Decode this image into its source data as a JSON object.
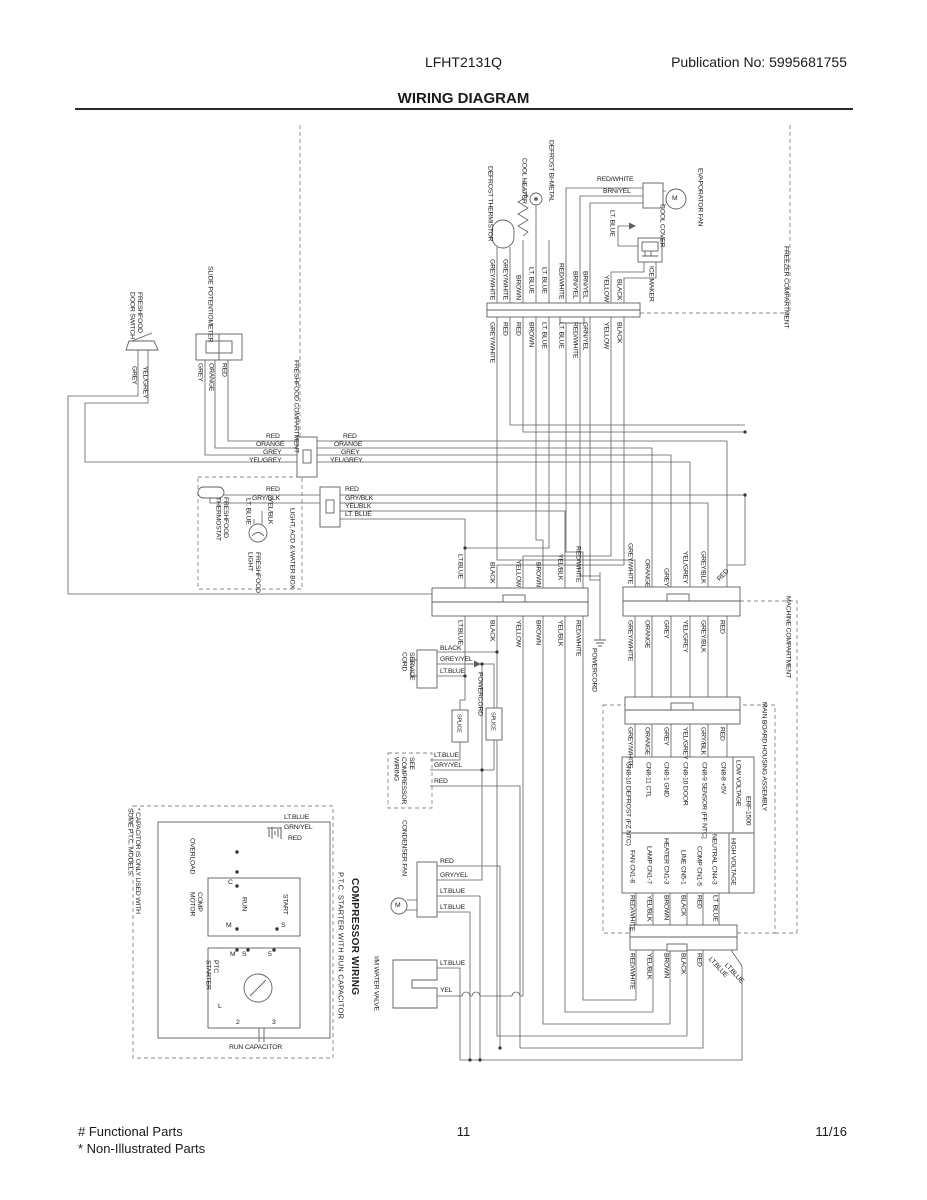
{
  "header": {
    "model": "LFHT2131Q",
    "publication": "Publication No:  5995681755",
    "title": "WIRING DIAGRAM"
  },
  "footer": {
    "functional": "# Functional Parts",
    "non_illustrated": "* Non-Illustrated Parts",
    "page": "11",
    "date": "11/16"
  },
  "diagram": {
    "labels": [
      {
        "t": "FRESHFOOD\nDOOR SWITCH",
        "x": 128,
        "y": 292,
        "o": "v"
      },
      {
        "t": "GREY",
        "x": 130,
        "y": 366,
        "o": "v"
      },
      {
        "t": "YEL/GREY",
        "x": 141,
        "y": 366,
        "o": "v"
      },
      {
        "t": "SLIDE POTENTIOMETER",
        "x": 206,
        "y": 266,
        "o": "v"
      },
      {
        "t": "GREY",
        "x": 196,
        "y": 363,
        "o": "v"
      },
      {
        "t": "ORANGE",
        "x": 207,
        "y": 363,
        "o": "v"
      },
      {
        "t": "RED",
        "x": 220,
        "y": 363,
        "o": "v"
      },
      {
        "t": "FRESHFOOD COMPARTMENT",
        "x": 292,
        "y": 360,
        "o": "v"
      },
      {
        "t": "RED",
        "x": 266,
        "y": 433
      },
      {
        "t": "ORANGE",
        "x": 256,
        "y": 441
      },
      {
        "t": "GREY",
        "x": 263,
        "y": 449
      },
      {
        "t": "YEL/GREY",
        "x": 249,
        "y": 457
      },
      {
        "t": "RED",
        "x": 343,
        "y": 433
      },
      {
        "t": "ORANGE",
        "x": 334,
        "y": 441
      },
      {
        "t": "GREY",
        "x": 341,
        "y": 449
      },
      {
        "t": "YEL/GREY",
        "x": 330,
        "y": 457
      },
      {
        "t": "RED",
        "x": 266,
        "y": 486
      },
      {
        "t": "GRY/BLK",
        "x": 252,
        "y": 495
      },
      {
        "t": "RED",
        "x": 345,
        "y": 486
      },
      {
        "t": "GRY/BLK",
        "x": 345,
        "y": 495
      },
      {
        "t": "YEL/BLK",
        "x": 345,
        "y": 503
      },
      {
        "t": "LT. BLUE",
        "x": 345,
        "y": 511
      },
      {
        "t": "FRESHFOOD\nTHERMOSTAT",
        "x": 214,
        "y": 497,
        "o": "v"
      },
      {
        "t": "LIGHT, ACD & WATER BOX",
        "x": 288,
        "y": 508,
        "o": "v"
      },
      {
        "t": "LT. BLUE",
        "x": 244,
        "y": 498,
        "o": "v"
      },
      {
        "t": "YEL/BLK",
        "x": 266,
        "y": 498,
        "o": "v"
      },
      {
        "t": "FRESHFOOD\nLIGHT",
        "x": 246,
        "y": 552,
        "o": "v"
      },
      {
        "t": "DEFROST THERMISTOR",
        "x": 486,
        "y": 166,
        "o": "v"
      },
      {
        "t": "COOL HEATER",
        "x": 520,
        "y": 158,
        "o": "v"
      },
      {
        "t": "DEFROST BI-METAL",
        "x": 547,
        "y": 140,
        "o": "v"
      },
      {
        "t": "RED/WHITE",
        "x": 597,
        "y": 176
      },
      {
        "t": "BRN/YEL",
        "x": 603,
        "y": 188
      },
      {
        "t": "LT. BLUE",
        "x": 608,
        "y": 210,
        "o": "v"
      },
      {
        "t": "COOL COVER",
        "x": 658,
        "y": 204,
        "o": "v"
      },
      {
        "t": "EVAPORATOR FAN",
        "x": 696,
        "y": 168,
        "o": "v"
      },
      {
        "t": "M",
        "x": 672,
        "y": 195
      },
      {
        "t": "ICE MAKER",
        "x": 647,
        "y": 266,
        "o": "v"
      },
      {
        "t": "FREEZER COMPARTMENT",
        "x": 782,
        "y": 246,
        "o": "v"
      },
      {
        "t": "GREY/WHITE",
        "x": 488,
        "y": 259,
        "o": "v"
      },
      {
        "t": "GREY/WHITE",
        "x": 501,
        "y": 259,
        "o": "v"
      },
      {
        "t": "BROWN",
        "x": 514,
        "y": 275,
        "o": "v"
      },
      {
        "t": "LT. BLUE",
        "x": 527,
        "y": 267,
        "o": "v"
      },
      {
        "t": "LT. BLUE",
        "x": 540,
        "y": 267,
        "o": "v"
      },
      {
        "t": "RED/WHITE",
        "x": 557,
        "y": 263,
        "o": "v"
      },
      {
        "t": "BRN/YEL",
        "x": 571,
        "y": 271,
        "o": "v"
      },
      {
        "t": "BRN/YEL",
        "x": 581,
        "y": 271,
        "o": "v"
      },
      {
        "t": "YELLOW",
        "x": 602,
        "y": 275,
        "o": "v"
      },
      {
        "t": "BLACK",
        "x": 615,
        "y": 279,
        "o": "v"
      },
      {
        "t": "GREY/WHITE",
        "x": 488,
        "y": 322,
        "o": "v"
      },
      {
        "t": "RED",
        "x": 501,
        "y": 322,
        "o": "v"
      },
      {
        "t": "RED",
        "x": 514,
        "y": 322,
        "o": "v"
      },
      {
        "t": "BROWN",
        "x": 527,
        "y": 322,
        "o": "v"
      },
      {
        "t": "LT. BLUE",
        "x": 540,
        "y": 322,
        "o": "v"
      },
      {
        "t": "LT. BLUE",
        "x": 557,
        "y": 322,
        "o": "v"
      },
      {
        "t": "RED/WHITE",
        "x": 571,
        "y": 322,
        "o": "v"
      },
      {
        "t": "GRN/YEL",
        "x": 581,
        "y": 322,
        "o": "v"
      },
      {
        "t": "YELLOW",
        "x": 602,
        "y": 322,
        "o": "v"
      },
      {
        "t": "BLACK",
        "x": 615,
        "y": 322,
        "o": "v"
      },
      {
        "t": "LT.BLUE",
        "x": 456,
        "y": 554,
        "o": "v"
      },
      {
        "t": "BLACK",
        "x": 488,
        "y": 562,
        "o": "v"
      },
      {
        "t": "YELLOW",
        "x": 514,
        "y": 560,
        "o": "v"
      },
      {
        "t": "BROWN",
        "x": 534,
        "y": 562,
        "o": "v"
      },
      {
        "t": "YEL/BLK",
        "x": 556,
        "y": 554,
        "o": "v"
      },
      {
        "t": "RED/WHITE",
        "x": 574,
        "y": 546,
        "o": "v"
      },
      {
        "t": "LT.BLUE",
        "x": 456,
        "y": 620,
        "o": "v"
      },
      {
        "t": "BLACK",
        "x": 488,
        "y": 620,
        "o": "v"
      },
      {
        "t": "YELLOW",
        "x": 514,
        "y": 620,
        "o": "v"
      },
      {
        "t": "BROWN",
        "x": 534,
        "y": 620,
        "o": "v"
      },
      {
        "t": "YEL/BLK",
        "x": 556,
        "y": 620,
        "o": "v"
      },
      {
        "t": "RED/WHITE",
        "x": 574,
        "y": 620,
        "o": "v"
      },
      {
        "t": "GREY/WHITE",
        "x": 626,
        "y": 543,
        "o": "v"
      },
      {
        "t": "ORANGE",
        "x": 643,
        "y": 559,
        "o": "v"
      },
      {
        "t": "GREY",
        "x": 662,
        "y": 568,
        "o": "v"
      },
      {
        "t": "YEL/GREY",
        "x": 681,
        "y": 551,
        "o": "v"
      },
      {
        "t": "GREY/BLK",
        "x": 699,
        "y": 551,
        "o": "v"
      },
      {
        "t": "RED",
        "x": 716,
        "y": 578,
        "o": "e"
      },
      {
        "t": "GREY/WHITE",
        "x": 626,
        "y": 620,
        "o": "v"
      },
      {
        "t": "ORANGE",
        "x": 643,
        "y": 620,
        "o": "v"
      },
      {
        "t": "GREY",
        "x": 662,
        "y": 620,
        "o": "v"
      },
      {
        "t": "YEL/GREY",
        "x": 681,
        "y": 620,
        "o": "v"
      },
      {
        "t": "GREY/BLK",
        "x": 699,
        "y": 620,
        "o": "v"
      },
      {
        "t": "RED",
        "x": 718,
        "y": 620,
        "o": "v"
      },
      {
        "t": "POWERCORD",
        "x": 590,
        "y": 648,
        "o": "v"
      },
      {
        "t": "SERVICE\nCORD",
        "x": 400,
        "y": 652,
        "o": "v"
      },
      {
        "t": "BLACK",
        "x": 440,
        "y": 645
      },
      {
        "t": "GREY/YEL",
        "x": 440,
        "y": 656
      },
      {
        "t": "LT.BLUE",
        "x": 440,
        "y": 668
      },
      {
        "t": "POWERCORD",
        "x": 476,
        "y": 672,
        "o": "v"
      },
      {
        "t": "SPLICE",
        "x": 455,
        "y": 714,
        "o": "v",
        "s": "st"
      },
      {
        "t": "SPLICE",
        "x": 489,
        "y": 712,
        "o": "v",
        "s": "st"
      },
      {
        "t": "SEE\nCOMPRESSOR\nWIRING",
        "x": 392,
        "y": 757,
        "o": "v"
      },
      {
        "t": "LT.BLUE",
        "x": 434,
        "y": 752
      },
      {
        "t": "GRY/YEL",
        "x": 434,
        "y": 762
      },
      {
        "t": "RED",
        "x": 434,
        "y": 778
      },
      {
        "t": "CONDENSER FAN",
        "x": 400,
        "y": 820,
        "o": "v"
      },
      {
        "t": "M",
        "x": 395,
        "y": 902
      },
      {
        "t": "RED",
        "x": 440,
        "y": 858
      },
      {
        "t": "GRY/YEL",
        "x": 440,
        "y": 872
      },
      {
        "t": "LT.BLUE",
        "x": 440,
        "y": 888
      },
      {
        "t": "LT.BLUE",
        "x": 440,
        "y": 904
      },
      {
        "t": "I/M WATER VALVE",
        "x": 372,
        "y": 956,
        "o": "v"
      },
      {
        "t": "LT.BLUE",
        "x": 440,
        "y": 960
      },
      {
        "t": "YEL",
        "x": 440,
        "y": 987
      },
      {
        "t": "MACHINE COMPARTMENT",
        "x": 784,
        "y": 596,
        "o": "v"
      },
      {
        "t": "MAIN BOARD HOUSING ASSEMBLY",
        "x": 760,
        "y": 702,
        "o": "v"
      },
      {
        "t": "ERF-1500",
        "x": 744,
        "y": 796,
        "o": "v"
      },
      {
        "t": "LOW VOLTAGE",
        "x": 734,
        "y": 760,
        "o": "v"
      },
      {
        "t": "HIGH VOLTAGE",
        "x": 729,
        "y": 838,
        "o": "v"
      },
      {
        "t": "GREY/WHITE",
        "x": 626,
        "y": 727,
        "o": "v"
      },
      {
        "t": "ORANGE",
        "x": 643,
        "y": 727,
        "o": "v"
      },
      {
        "t": "GREY",
        "x": 662,
        "y": 727,
        "o": "v"
      },
      {
        "t": "YEL/GREY",
        "x": 681,
        "y": 727,
        "o": "v"
      },
      {
        "t": "GRY/BLK",
        "x": 699,
        "y": 727,
        "o": "v"
      },
      {
        "t": "RED",
        "x": 718,
        "y": 727,
        "o": "v"
      },
      {
        "t": "CN8-10 DEFROST (FZ NTC)",
        "x": 624,
        "y": 762,
        "o": "v"
      },
      {
        "t": "CN8-11 CTL",
        "x": 644,
        "y": 762,
        "o": "v"
      },
      {
        "t": "CN8-1 GND",
        "x": 662,
        "y": 762,
        "o": "v"
      },
      {
        "t": "CN8-10 DOOR",
        "x": 681,
        "y": 762,
        "o": "v"
      },
      {
        "t": "CN8-9 SENSOR (FF NTC)",
        "x": 700,
        "y": 762,
        "o": "v"
      },
      {
        "t": "CN8-8 +5V",
        "x": 719,
        "y": 762,
        "o": "v"
      },
      {
        "t": "FAN CN1-8",
        "x": 628,
        "y": 850,
        "o": "v"
      },
      {
        "t": "LAMP CN1-7",
        "x": 645,
        "y": 846,
        "o": "v"
      },
      {
        "t": "HEATER CN1-3",
        "x": 662,
        "y": 838,
        "o": "v"
      },
      {
        "t": "LINE CN5-1",
        "x": 679,
        "y": 850,
        "o": "v"
      },
      {
        "t": "COMP CN1-5",
        "x": 695,
        "y": 846,
        "o": "v"
      },
      {
        "t": "NEUTRAL CN4-3",
        "x": 710,
        "y": 834,
        "o": "v"
      },
      {
        "t": "RED/WHITE",
        "x": 628,
        "y": 895,
        "o": "v"
      },
      {
        "t": "YEL/BLK",
        "x": 645,
        "y": 895,
        "o": "v"
      },
      {
        "t": "BROWN",
        "x": 662,
        "y": 895,
        "o": "v"
      },
      {
        "t": "BLACK",
        "x": 679,
        "y": 895,
        "o": "v"
      },
      {
        "t": "RED",
        "x": 695,
        "y": 895,
        "o": "v"
      },
      {
        "t": "LT. BLUE",
        "x": 711,
        "y": 895,
        "o": "v"
      },
      {
        "t": "RED/WHITE",
        "x": 628,
        "y": 953,
        "o": "v"
      },
      {
        "t": "YEL/BLK",
        "x": 645,
        "y": 953,
        "o": "v"
      },
      {
        "t": "BROWN",
        "x": 662,
        "y": 953,
        "o": "v"
      },
      {
        "t": "BLACK",
        "x": 679,
        "y": 953,
        "o": "v"
      },
      {
        "t": "RED",
        "x": 695,
        "y": 953,
        "o": "v"
      },
      {
        "t": "LT.BLUE",
        "x": 712,
        "y": 956,
        "o": "d"
      },
      {
        "t": "LT.BLUE",
        "x": 728,
        "y": 962,
        "o": "d"
      },
      {
        "t": "* CAPACITOR IS ONLY USED WITH\nSOME P.T.C. MODELS.",
        "x": 126,
        "y": 808,
        "o": "v"
      },
      {
        "t": "OVERLOAD",
        "x": 188,
        "y": 838,
        "o": "v"
      },
      {
        "t": "COMP\nMOTOR",
        "x": 188,
        "y": 892,
        "o": "v"
      },
      {
        "t": "RUN",
        "x": 240,
        "y": 897,
        "o": "v"
      },
      {
        "t": "START",
        "x": 281,
        "y": 894,
        "o": "v"
      },
      {
        "t": "C",
        "x": 228,
        "y": 879
      },
      {
        "t": "M",
        "x": 226,
        "y": 922
      },
      {
        "t": "S",
        "x": 281,
        "y": 922
      },
      {
        "t": "PTC\nSTARTER",
        "x": 204,
        "y": 960,
        "o": "v"
      },
      {
        "t": "M",
        "x": 230,
        "y": 951
      },
      {
        "t": "S",
        "x": 242,
        "y": 951
      },
      {
        "t": "5",
        "x": 268,
        "y": 951
      },
      {
        "t": "L",
        "x": 218,
        "y": 1003
      },
      {
        "t": "2",
        "x": 236,
        "y": 1019
      },
      {
        "t": "3",
        "x": 272,
        "y": 1019
      },
      {
        "t": "RUN CAPACITOR",
        "x": 229,
        "y": 1044
      },
      {
        "t": "LT.BLUE",
        "x": 284,
        "y": 814
      },
      {
        "t": "GRN/YEL",
        "x": 284,
        "y": 824
      },
      {
        "t": "RED",
        "x": 288,
        "y": 835
      },
      {
        "t": "COMPRESSOR WIRING",
        "x": 349,
        "y": 878,
        "o": "v",
        "s": "sb"
      },
      {
        "t": "P.T.C. STARTER WITH RUN CAPACITOR",
        "x": 336,
        "y": 872,
        "o": "v",
        "s": "sm"
      }
    ]
  }
}
